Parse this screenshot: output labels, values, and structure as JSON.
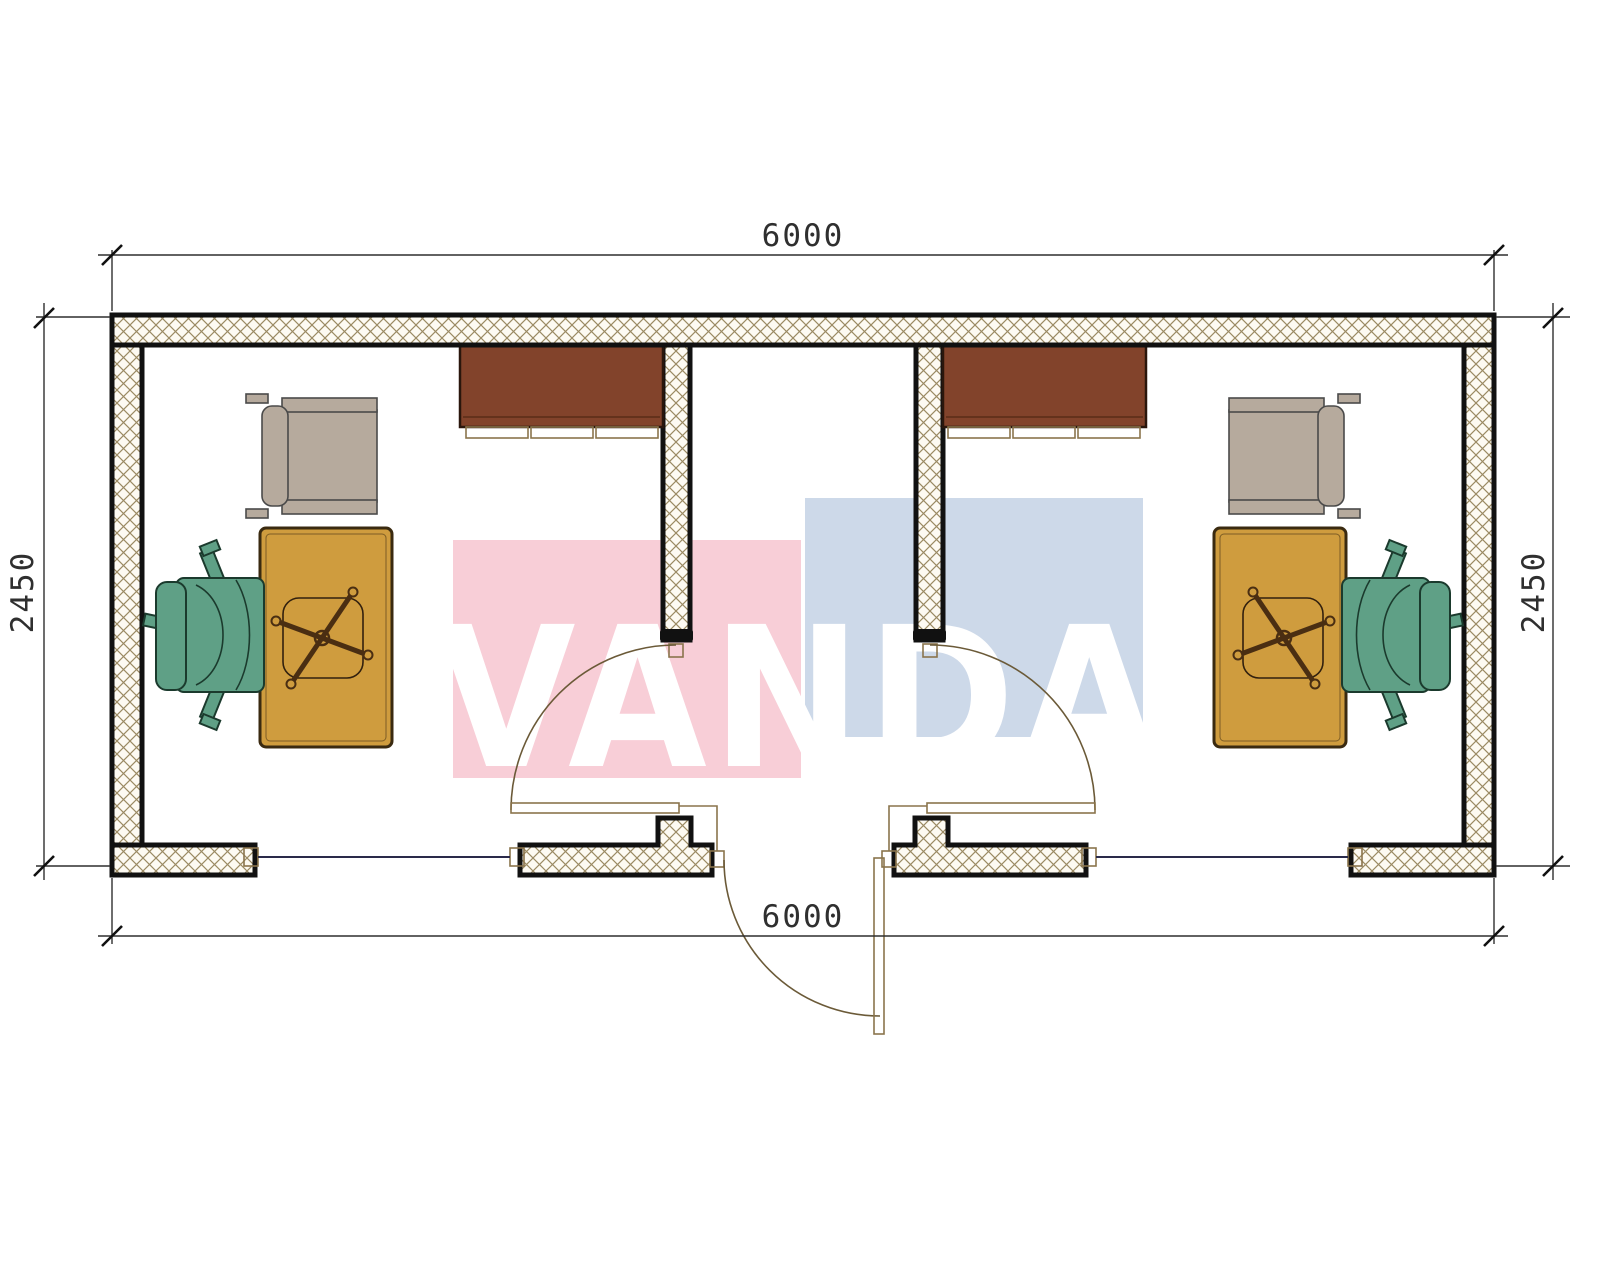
{
  "watermark": {
    "text": "VANDA",
    "text_color": "#ffffff",
    "pink_block": "#f8ced7",
    "blue_block": "#cdd9e9"
  },
  "dimensions": {
    "top": "6000",
    "bottom": "6000",
    "left": "2450",
    "right": "2450"
  },
  "colors": {
    "wall_fill": "#fdfaf2",
    "wall_hatch_line": "#9b8a63",
    "wall_outline": "#111111",
    "desk": "#cf9c3e",
    "desk_outline": "#3a2a10",
    "cabinet": "#82432b",
    "cabinet_outline": "#2a160c",
    "chair_green": "#5fa086",
    "chair_green_outline": "#1b3a2d",
    "chair_gray": "#b6aa9d",
    "chair_gray_outline": "#4a4a4a",
    "door_frame_line": "#8a744c",
    "door_swing_arc": "#6b5a38",
    "window_line": "#2a2a4a",
    "dimension_line": "#2f2f2f"
  },
  "rooms": {
    "left_office": {
      "furniture": [
        "wall-cabinet",
        "visitor-armchair",
        "desk",
        "task-chair"
      ]
    },
    "corridor": {
      "door": "entrance-door"
    },
    "right_office": {
      "furniture": [
        "wall-cabinet",
        "visitor-armchair",
        "desk",
        "task-chair"
      ]
    }
  }
}
